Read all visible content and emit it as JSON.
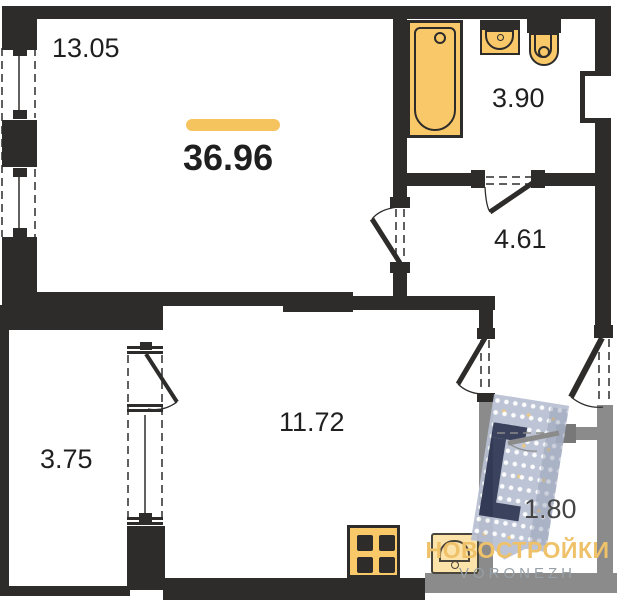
{
  "plan": {
    "total_area": "36.96",
    "rooms": [
      {
        "name": "living-room",
        "area": "13.05"
      },
      {
        "name": "bathroom",
        "area": "3.90"
      },
      {
        "name": "hallway",
        "area": "4.61"
      },
      {
        "name": "kitchen-living-room",
        "area": "11.72"
      },
      {
        "name": "balcony",
        "area": "3.75"
      },
      {
        "name": "entry-loggia",
        "area": "1.80"
      }
    ],
    "icons": [
      "bathtub-icon",
      "sink-icon",
      "toilet-icon",
      "stove-icon",
      "kitchen-sink-icon",
      "building-watermark-icon"
    ]
  },
  "branding": {
    "logo_text": "НОВОСТРОЙКИ",
    "logo_subtext": "VORONEZH"
  },
  "colors": {
    "wall": "#2d2c2b",
    "wall_gray": "#8b8b8b",
    "fixture_fill": "#f9c869",
    "fixture_pale": "#fce3a9",
    "accent_bar": "#f6c45e",
    "label": "#1f1f1f",
    "watermark_body": "#b9c0d2",
    "watermark_dark": "#2c3452",
    "logo_yellow": "#efc169",
    "logo_gray": "#97a0a7"
  }
}
